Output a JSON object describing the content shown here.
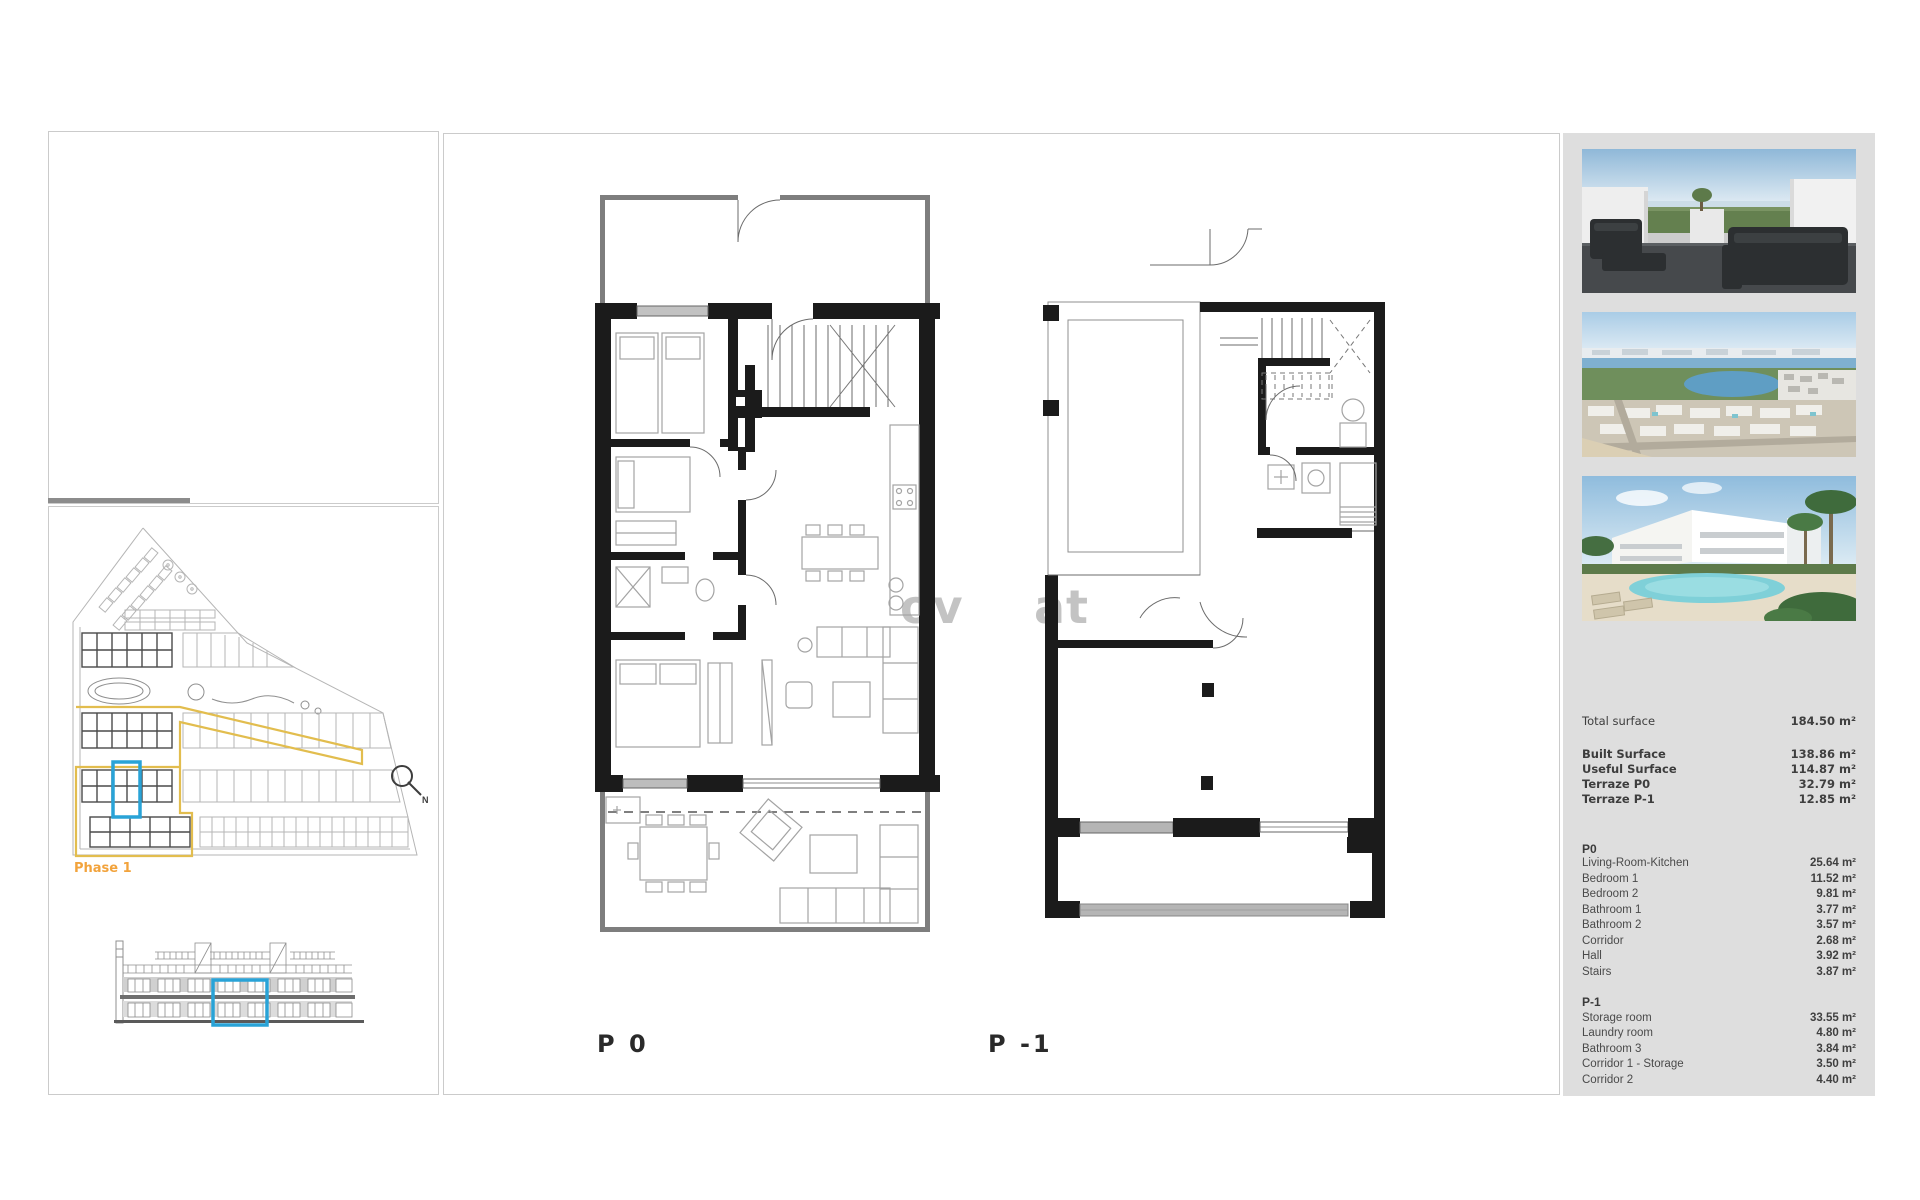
{
  "watermark": {
    "left": "ov",
    "right": "at"
  },
  "site_plan": {
    "phase_label": "Phase 1",
    "north_label": "N"
  },
  "plans": {
    "p0_label": "P 0",
    "p1_label": "P -1"
  },
  "colors": {
    "highlight_blue": "#29a3d7",
    "phase_yellow": "#e2bd4e",
    "phase_orange": "#f2a33c",
    "wall_black": "#1b1b1b"
  },
  "sidebar": {
    "total": {
      "label": "Total surface",
      "value": "184.50 m²"
    },
    "surfaces": [
      {
        "label": "Built Surface",
        "value": "138.86 m²"
      },
      {
        "label": "Useful Surface",
        "value": "114.87 m²"
      },
      {
        "label": "Terraze P0",
        "value": "32.79 m²"
      },
      {
        "label": "Terraze P-1",
        "value": "12.85 m²"
      }
    ],
    "p0": {
      "title": "P0",
      "rows": [
        {
          "label": "Living-Room-Kitchen",
          "value": "25.64 m²"
        },
        {
          "label": "Bedroom 1",
          "value": "11.52 m²"
        },
        {
          "label": "Bedroom 2",
          "value": "9.81 m²"
        },
        {
          "label": "Bathroom 1",
          "value": "3.77 m²"
        },
        {
          "label": "Bathroom 2",
          "value": "3.57 m²"
        },
        {
          "label": "Corridor",
          "value": "2.68 m²"
        },
        {
          "label": "Hall",
          "value": "3.92 m²"
        },
        {
          "label": "Stairs",
          "value": "3.87 m²"
        }
      ]
    },
    "p1": {
      "title": "P-1",
      "rows": [
        {
          "label": "Storage room",
          "value": "33.55 m²"
        },
        {
          "label": "Laundry room",
          "value": "4.80 m²"
        },
        {
          "label": "Bathroom 3",
          "value": "3.84 m²"
        },
        {
          "label": "Corridor 1 - Storage",
          "value": "3.50 m²"
        },
        {
          "label": "Corridor 2",
          "value": "4.40 m²"
        }
      ]
    },
    "photos": [
      {
        "name": "terrace-render"
      },
      {
        "name": "aerial-coast-view"
      },
      {
        "name": "pool-and-villas-render"
      }
    ]
  }
}
